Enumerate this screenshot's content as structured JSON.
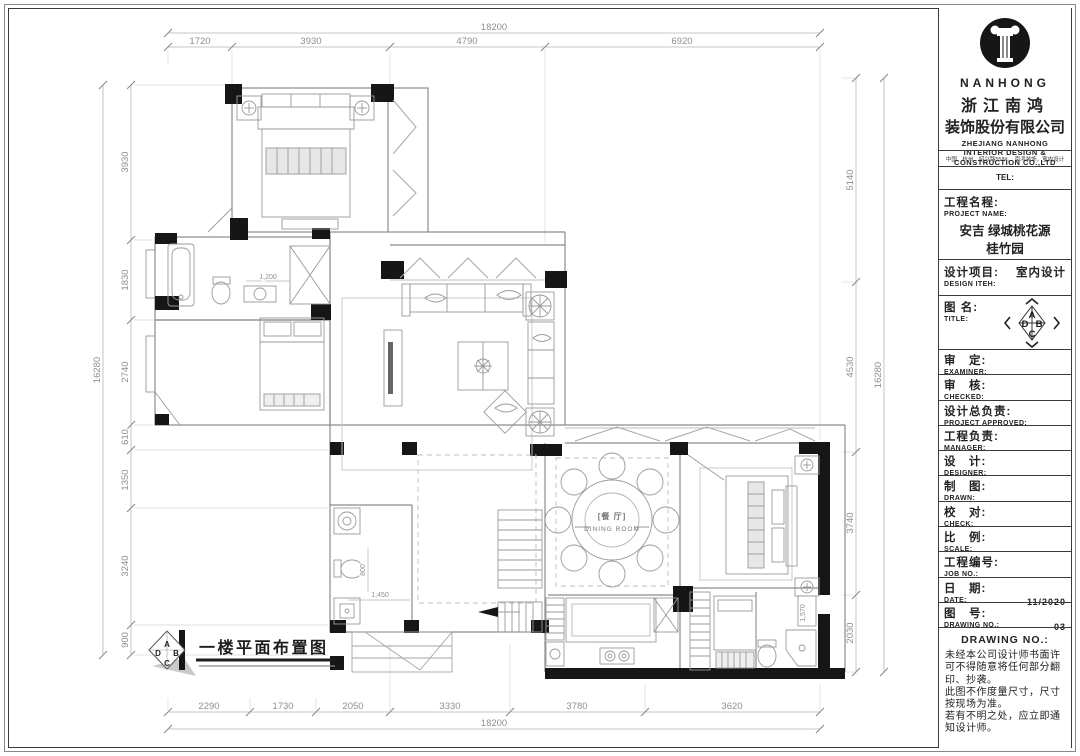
{
  "compass": {
    "a": "A",
    "b": "B",
    "c": "C",
    "d": "D"
  },
  "plan": {
    "floor_label": "一楼平面布置图",
    "rooms": {
      "dining_cn": "[餐 厅]",
      "dining_en": "DINING ROOM"
    },
    "dims": {
      "top": {
        "overall": "18200",
        "seg": [
          "1720",
          "3930",
          "4790",
          "6920"
        ]
      },
      "bottom": {
        "overall": "18200",
        "seg": [
          "2290",
          "1730",
          "2050",
          "3330",
          "3780",
          "3620"
        ]
      },
      "left": {
        "overall": "16280",
        "seg": [
          "3930",
          "1830",
          "2740",
          "610",
          "1350",
          "3240",
          "900"
        ]
      },
      "right": {
        "overall": "16280",
        "seg": [
          "5140",
          "4530",
          "3740",
          "2030"
        ]
      },
      "interior": {
        "vanity": "1,200",
        "stair_w": "1,450",
        "stair_d": "800",
        "bath": "1,570"
      }
    }
  },
  "titleblock": {
    "brand": {
      "logo": "NANHONG",
      "cn1": "浙江南鸿",
      "cn2": "装饰股份有限公司",
      "en1": "ZHEJIANG NANHONG",
      "en2": "INTERIOR DESIGN &",
      "en3": "CONSTRUCTION CO.,LTD",
      "address": "中国．杭州．绍兴路558#，  南鸿装饰，室内设计",
      "tel": "TEL:"
    },
    "project": {
      "cn": "工程名程:",
      "en": "PROJECT NAME:",
      "line1": "安吉 绿城桃花源",
      "line2": "桂竹园"
    },
    "design_item": {
      "cn": "设计项目:",
      "value": "室内设计",
      "en": "DESIGN ITEH:"
    },
    "drawing_title": {
      "cn": "图 名:",
      "en": "TITLE:"
    },
    "rows": [
      {
        "cn": "审　定:",
        "en": "EXAMINER:",
        "value": ""
      },
      {
        "cn": "审　核:",
        "en": "CHECKED:",
        "value": ""
      },
      {
        "cn": "设计总负责:",
        "en": "PROJECT APPROVED:",
        "value": ""
      },
      {
        "cn": "工程负责:",
        "en": "MANAGER:",
        "value": ""
      },
      {
        "cn": "设　计:",
        "en": "DESIGNER:",
        "value": ""
      },
      {
        "cn": "制　图:",
        "en": "DRAWN:",
        "value": ""
      },
      {
        "cn": "校　对:",
        "en": "CHECK:",
        "value": ""
      },
      {
        "cn": "比　例:",
        "en": "SCALE:",
        "value": ""
      },
      {
        "cn": "工程编号:",
        "en": "JOB NO.:",
        "value": ""
      },
      {
        "cn": "日　期:",
        "en": "DATE:",
        "value": "11/2020"
      },
      {
        "cn": "图　号:",
        "en": "DRAWING NO.:",
        "value": "03"
      }
    ],
    "notes_header": "DRAWING NO.:",
    "notes": [
      "未经本公司设计师书面许可不得随意将任何部分翻印、抄袭。",
      "此图不作度量尺寸，尺寸按现场为准。",
      "若有不明之处，应立即通知设计师。"
    ]
  }
}
